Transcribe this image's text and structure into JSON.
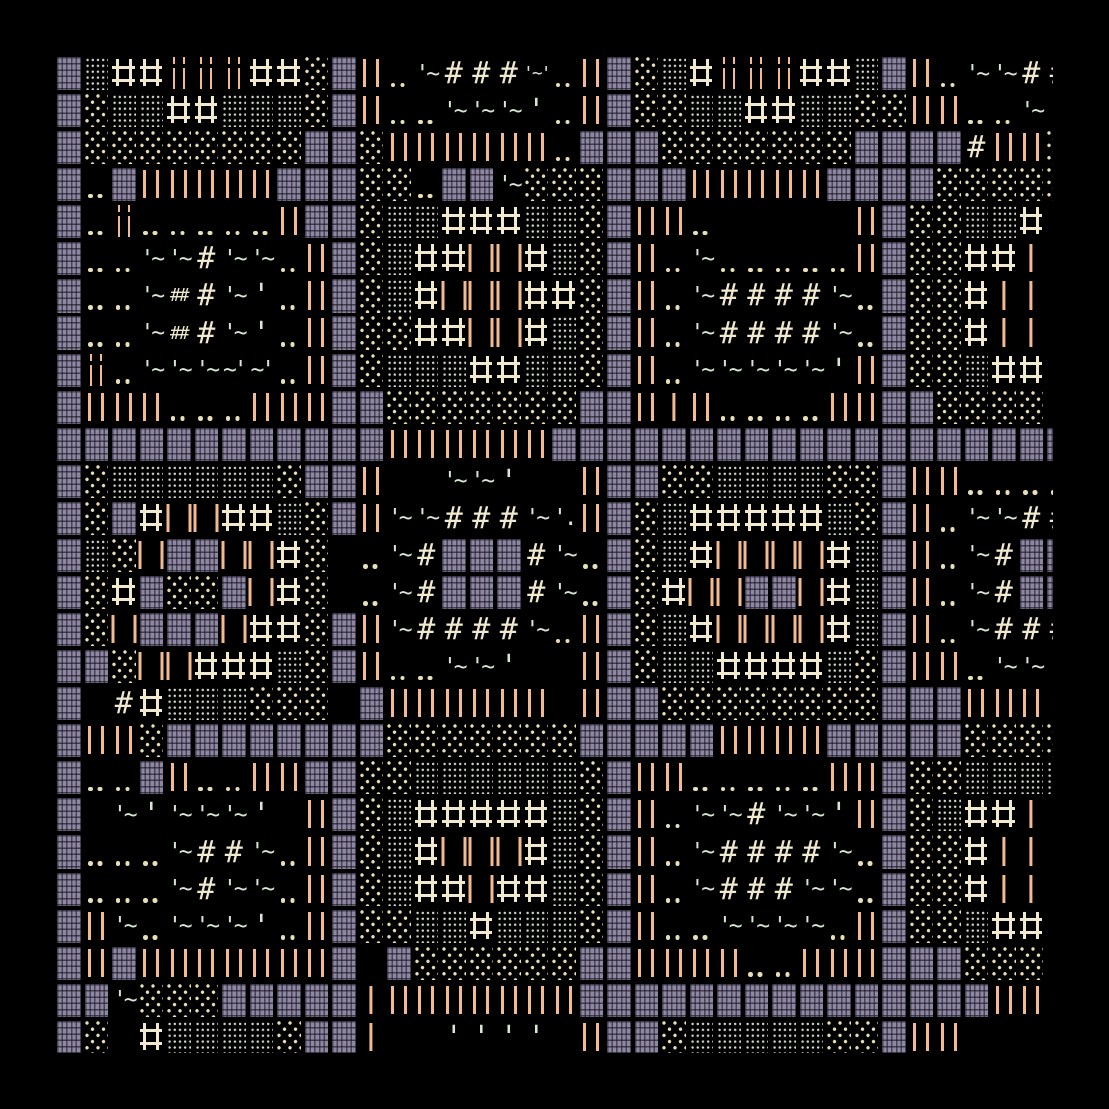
{
  "artwork": {
    "title": "textmode generative pattern",
    "background": "#000000",
    "palette": {
      "purple_block": "#8e87a2",
      "orange_bar": "#f2ba8e",
      "cream_glyph": "#f0e9cd",
      "mint_glyph": "#d8e6d6",
      "cream_dot": "#e9dfb6",
      "mint_dot": "#ccd8c9"
    },
    "grid": {
      "cols": 37,
      "rows": 27,
      "origin_x": 55,
      "origin_y": 55,
      "cell_width": 27.5,
      "cell_height": 37.07,
      "clip_right_x": 1053,
      "clip_bottom_y": 1053
    },
    "legend": {
      "B": "woven purple block",
      "D": "dense mint dot block",
      "O": "sparse cream dot lattice block",
      "+": "cream double-line cross",
      "I": "orange double bar",
      "i": "thin broken orange double bar",
      "l": "orange single bar",
      "ll": "spread orange bar pair",
      ".": "cream dot pair",
      "other": "literal glyph string (mint quotes/tildes, cream hashes)"
    },
    "rows": [
      [
        "B",
        "D",
        "+",
        "+",
        "i",
        "i",
        "i",
        "+",
        "+",
        "O",
        "B",
        "I",
        ".",
        "'~",
        "#",
        "#",
        "#",
        "'~'",
        ".",
        "I",
        "B",
        "O",
        "D",
        "+",
        "i",
        "i",
        "i",
        "+",
        "+",
        "D",
        "B",
        "I",
        ".",
        "'~",
        "'~",
        "#",
        "#"
      ],
      [
        "B",
        "O",
        "D",
        "D",
        "+",
        "+",
        "D",
        "D",
        "D",
        "O",
        "B",
        "I",
        ".",
        ".",
        "'~",
        "'~",
        "'~",
        "'",
        ".",
        "I",
        "B",
        "O",
        "O",
        "D",
        "D",
        "+",
        "+",
        "D",
        "D",
        "O",
        "O",
        "I",
        "I",
        ".",
        ".",
        "'~",
        "'"
      ],
      [
        "B",
        "O",
        "O",
        "O",
        "O",
        "O",
        "O",
        "O",
        "O",
        "B",
        "B",
        "O",
        "I",
        "I",
        "I",
        "I",
        "I",
        "I",
        ".",
        "B",
        "B",
        "B",
        "O",
        "O",
        "O",
        "O",
        "O",
        "O",
        "O",
        "B",
        "B",
        "B",
        "B",
        "#",
        "I",
        "I",
        "O"
      ],
      [
        "B",
        ".",
        "B",
        "I",
        "I",
        "I",
        "I",
        "I",
        "B",
        "B",
        "B",
        "O",
        "O",
        ".",
        "B",
        "B",
        "'~",
        "O",
        "O",
        "O",
        "B",
        "B",
        "B",
        "I",
        "I",
        "I",
        "I",
        "I",
        "B",
        "B",
        "B",
        "B",
        "O",
        "O",
        "O",
        "O",
        "O"
      ],
      [
        "B",
        ".",
        "i",
        ".",
        ".",
        ".",
        ".",
        ".",
        "I",
        "B",
        "B",
        "O",
        "D",
        "D",
        "+",
        "+",
        "+",
        "D",
        "D",
        "O",
        "B",
        "I",
        "I",
        ".",
        "",
        "",
        "",
        "",
        "",
        "I",
        "B",
        "O",
        "O",
        "D",
        "D",
        "+",
        ""
      ],
      [
        "B",
        ".",
        ".",
        "'~",
        "'~",
        "#",
        "'~",
        "'~",
        ".",
        "I",
        "B",
        "O",
        "D",
        "+",
        "+",
        "ll",
        "ll",
        "+",
        "D",
        "O",
        "B",
        "I",
        ".",
        "'~",
        ".",
        ".",
        ".",
        ".",
        ".",
        "I",
        "B",
        "O",
        "O",
        "+",
        "+",
        "l",
        "l"
      ],
      [
        "B",
        ".",
        ".",
        "'~",
        "##",
        "#",
        "'~",
        "'",
        ".",
        "I",
        "B",
        "O",
        "D",
        "+",
        "ll",
        "ll",
        "ll",
        "+",
        "+",
        "O",
        "B",
        "I",
        ".",
        "'~",
        "#",
        "#",
        "#",
        "#",
        "'~",
        ".",
        "B",
        "O",
        "O",
        "+",
        "l",
        "l",
        "l"
      ],
      [
        "B",
        ".",
        ".",
        "'~",
        "##",
        "#",
        "'~",
        "'",
        ".",
        "I",
        "B",
        "O",
        "O",
        "+",
        "+",
        "ll",
        "ll",
        "+",
        "D",
        "O",
        "B",
        "I",
        ".",
        "'~",
        "#",
        "#",
        "#",
        "#",
        "'~",
        ".",
        "B",
        "O",
        "O",
        "+",
        "l",
        "l",
        "l"
      ],
      [
        "B",
        "i",
        ".",
        "'~",
        "'~",
        "'~",
        "~'",
        "~'",
        ".",
        "I",
        "B",
        "O",
        "D",
        "D",
        "D",
        "+",
        "+",
        "D",
        "D",
        "O",
        "B",
        "I",
        ".",
        "'~",
        "'~",
        "'~",
        "'~",
        "'~",
        "'",
        "I",
        "B",
        "O",
        "O",
        "D",
        "+",
        "+",
        ""
      ],
      [
        "B",
        "I",
        "I",
        "I",
        ".",
        ".",
        ".",
        "I",
        "I",
        "I",
        "B",
        "B",
        "O",
        "O",
        "O",
        "O",
        "O",
        "O",
        "O",
        "B",
        "B",
        "I",
        "l",
        "I",
        ".",
        ".",
        ".",
        ".",
        "I",
        "I",
        "B",
        "B",
        "O",
        "O",
        "O",
        "O",
        ""
      ],
      [
        "B",
        "B",
        "B",
        "B",
        "B",
        "B",
        "B",
        "B",
        "B",
        "B",
        "B",
        "B",
        "I",
        "I",
        "I",
        "I",
        "I",
        "I",
        "B",
        "B",
        "B",
        "B",
        "B",
        "B",
        "B",
        "B",
        "B",
        "B",
        "B",
        "B",
        "B",
        "B",
        "B",
        "B",
        "B",
        "B",
        "B"
      ],
      [
        "B",
        "O",
        "D",
        "D",
        "D",
        "D",
        "D",
        "D",
        "O",
        "B",
        "B",
        "I",
        "",
        "",
        "'~",
        "'~",
        "'",
        "",
        "",
        "I",
        "B",
        "B",
        "O",
        "O",
        "D",
        "D",
        "D",
        "D",
        "O",
        "O",
        "B",
        "I",
        "I",
        ".",
        ".",
        ".",
        "."
      ],
      [
        "B",
        "O",
        "B",
        "+",
        "ll",
        "ll",
        "+",
        "+",
        "D",
        "O",
        "B",
        "I",
        "'~",
        "'~",
        "#",
        "#",
        "#",
        "'~",
        "'.",
        "I",
        "B",
        "O",
        "D",
        "+",
        "+",
        "+",
        "+",
        "+",
        "D",
        "O",
        "B",
        "I",
        ".",
        "'~",
        "'~",
        "#",
        "#"
      ],
      [
        "B",
        "D",
        "O",
        "ll",
        "B",
        "B",
        "ll",
        "ll",
        "+",
        "O",
        "",
        ".",
        "'~",
        "#",
        "B",
        "B",
        "B",
        "#",
        "'~",
        ".",
        "B",
        "O",
        "D",
        "+",
        "ll",
        "ll",
        "ll",
        "ll",
        "+",
        "D",
        "B",
        "I",
        ".",
        "'~",
        "#",
        "B",
        "B"
      ],
      [
        "B",
        "O",
        "+",
        "B",
        "O",
        "O",
        "B",
        "ll",
        "+",
        "O",
        "",
        ".",
        "'~",
        "#",
        "B",
        "B",
        "B",
        "#",
        "'~",
        ".",
        "B",
        "O",
        "+",
        "ll",
        "ll",
        "B",
        "B",
        "ll",
        "+",
        "D",
        "B",
        "I",
        ".",
        "'~",
        "#",
        "B",
        "B"
      ],
      [
        "B",
        "O",
        "ll",
        "B",
        "B",
        "B",
        "ll",
        "+",
        "+",
        "O",
        "B",
        "I",
        "'~",
        "#",
        "#",
        "#",
        "#",
        "'~",
        ".",
        "I",
        "B",
        "O",
        "D",
        "+",
        "ll",
        "ll",
        "ll",
        "ll",
        "+",
        "D",
        "B",
        "I",
        ".",
        "'~",
        "#",
        "#",
        "#"
      ],
      [
        "B",
        "B",
        "O",
        "ll",
        "ll",
        "+",
        "+",
        "+",
        "D",
        "O",
        "B",
        "I",
        ".",
        ".",
        "'~",
        "'~",
        "'",
        "",
        "",
        "I",
        "B",
        "O",
        "D",
        "D",
        "+",
        "+",
        "+",
        "+",
        "D",
        "O",
        "B",
        "I",
        "I",
        ".",
        "'~",
        "'~",
        "'"
      ],
      [
        "B",
        "",
        "#",
        "+",
        "D",
        "D",
        "D",
        "O",
        "O",
        "O",
        "",
        "B",
        "I",
        "I",
        "I",
        "I",
        "I",
        "I",
        "",
        "I",
        "B",
        "B",
        "O",
        "O",
        "O",
        "O",
        "O",
        "O",
        "O",
        "O",
        "B",
        "B",
        "B",
        "I",
        "I",
        "I",
        ""
      ],
      [
        "B",
        "I",
        "I",
        "O",
        "B",
        "B",
        "B",
        "B",
        "B",
        "B",
        "B",
        "B",
        "O",
        "O",
        "O",
        "O",
        "O",
        "O",
        "O",
        "B",
        "B",
        "B",
        "B",
        "B",
        "I",
        "I",
        "I",
        "I",
        "B",
        "B",
        "B",
        "B",
        "B",
        "O",
        "O",
        "O",
        "O"
      ],
      [
        "B",
        ".",
        ".",
        "B",
        "I",
        ".",
        ".",
        "I",
        "I",
        "B",
        "B",
        "O",
        "O",
        "D",
        "D",
        "D",
        "D",
        "D",
        "D",
        "O",
        "B",
        "I",
        "I",
        ".",
        ".",
        ".",
        ".",
        ".",
        "I",
        "I",
        "B",
        "O",
        "O",
        "D",
        "D",
        "D",
        "D"
      ],
      [
        "B",
        "",
        "'~",
        "'",
        "'~",
        "'~",
        "'~",
        "'",
        "",
        "I",
        "B",
        "O",
        "D",
        "+",
        "+",
        "+",
        "+",
        "+",
        "D",
        "O",
        "B",
        "I",
        ".",
        "'~",
        "'~",
        "#",
        "'~",
        "'~",
        "'",
        "I",
        "B",
        "O",
        "D",
        "+",
        "+",
        "l",
        "l"
      ],
      [
        "B",
        ".",
        ".",
        ".",
        "'~",
        "#",
        "#",
        "'~",
        ".",
        "I",
        "B",
        "O",
        "D",
        "+",
        "ll",
        "ll",
        "ll",
        "+",
        "D",
        "O",
        "B",
        "I",
        ".",
        "'~",
        "#",
        "#",
        "#",
        "#",
        "'~",
        ".",
        "B",
        "O",
        "O",
        "+",
        "l",
        "l",
        "l"
      ],
      [
        "B",
        ".",
        ".",
        ".",
        "'~",
        "#",
        "'~",
        "'~",
        ".",
        "I",
        "B",
        "O",
        "D",
        "+",
        "+",
        "ll",
        "+",
        "+",
        "D",
        "O",
        "B",
        "I",
        ".",
        "'~",
        "#",
        "#",
        "#",
        "'~",
        "'~",
        ".",
        "B",
        "O",
        "O",
        "+",
        "l",
        "l",
        "l"
      ],
      [
        "B",
        "I",
        "'~",
        ".",
        "'~",
        "'~",
        "'~",
        "'",
        ".",
        "I",
        "B",
        "O",
        "O",
        "D",
        "D",
        "+",
        "D",
        "D",
        "D",
        "O",
        "B",
        "I",
        ".",
        ".",
        "'~",
        "'~",
        "'~",
        "'~",
        ".",
        "I",
        "B",
        "O",
        "O",
        "D",
        "+",
        "+",
        ""
      ],
      [
        "B",
        "I",
        "B",
        "I",
        "I",
        "I",
        "I",
        "I",
        "I",
        "I",
        "B",
        "",
        "B",
        "O",
        "O",
        "O",
        "O",
        "O",
        "O",
        "B",
        "B",
        "I",
        "I",
        "I",
        "I",
        ".",
        ".",
        "I",
        "I",
        "I",
        "B",
        "B",
        "B",
        "O",
        "O",
        "O",
        ""
      ],
      [
        "B",
        "B",
        "'~",
        "O",
        "O",
        "O",
        "B",
        "B",
        "B",
        "B",
        "B",
        "l",
        "I",
        "I",
        "I",
        "I",
        "I",
        "I",
        "I",
        "B",
        "B",
        "B",
        "B",
        "B",
        "B",
        "B",
        "B",
        "B",
        "B",
        "B",
        "B",
        "B",
        "B",
        "B",
        "I",
        "I",
        ""
      ],
      [
        "B",
        "O",
        "",
        "+",
        "D",
        "D",
        "D",
        "D",
        "O",
        "B",
        "B",
        "l",
        "",
        "",
        "'",
        "'",
        "'",
        "'",
        "",
        "I",
        "B",
        "B",
        "O",
        "D",
        "D",
        "D",
        "D",
        "D",
        "O",
        "O",
        "B",
        "I",
        "I",
        "",
        "",
        "",
        ""
      ]
    ]
  }
}
